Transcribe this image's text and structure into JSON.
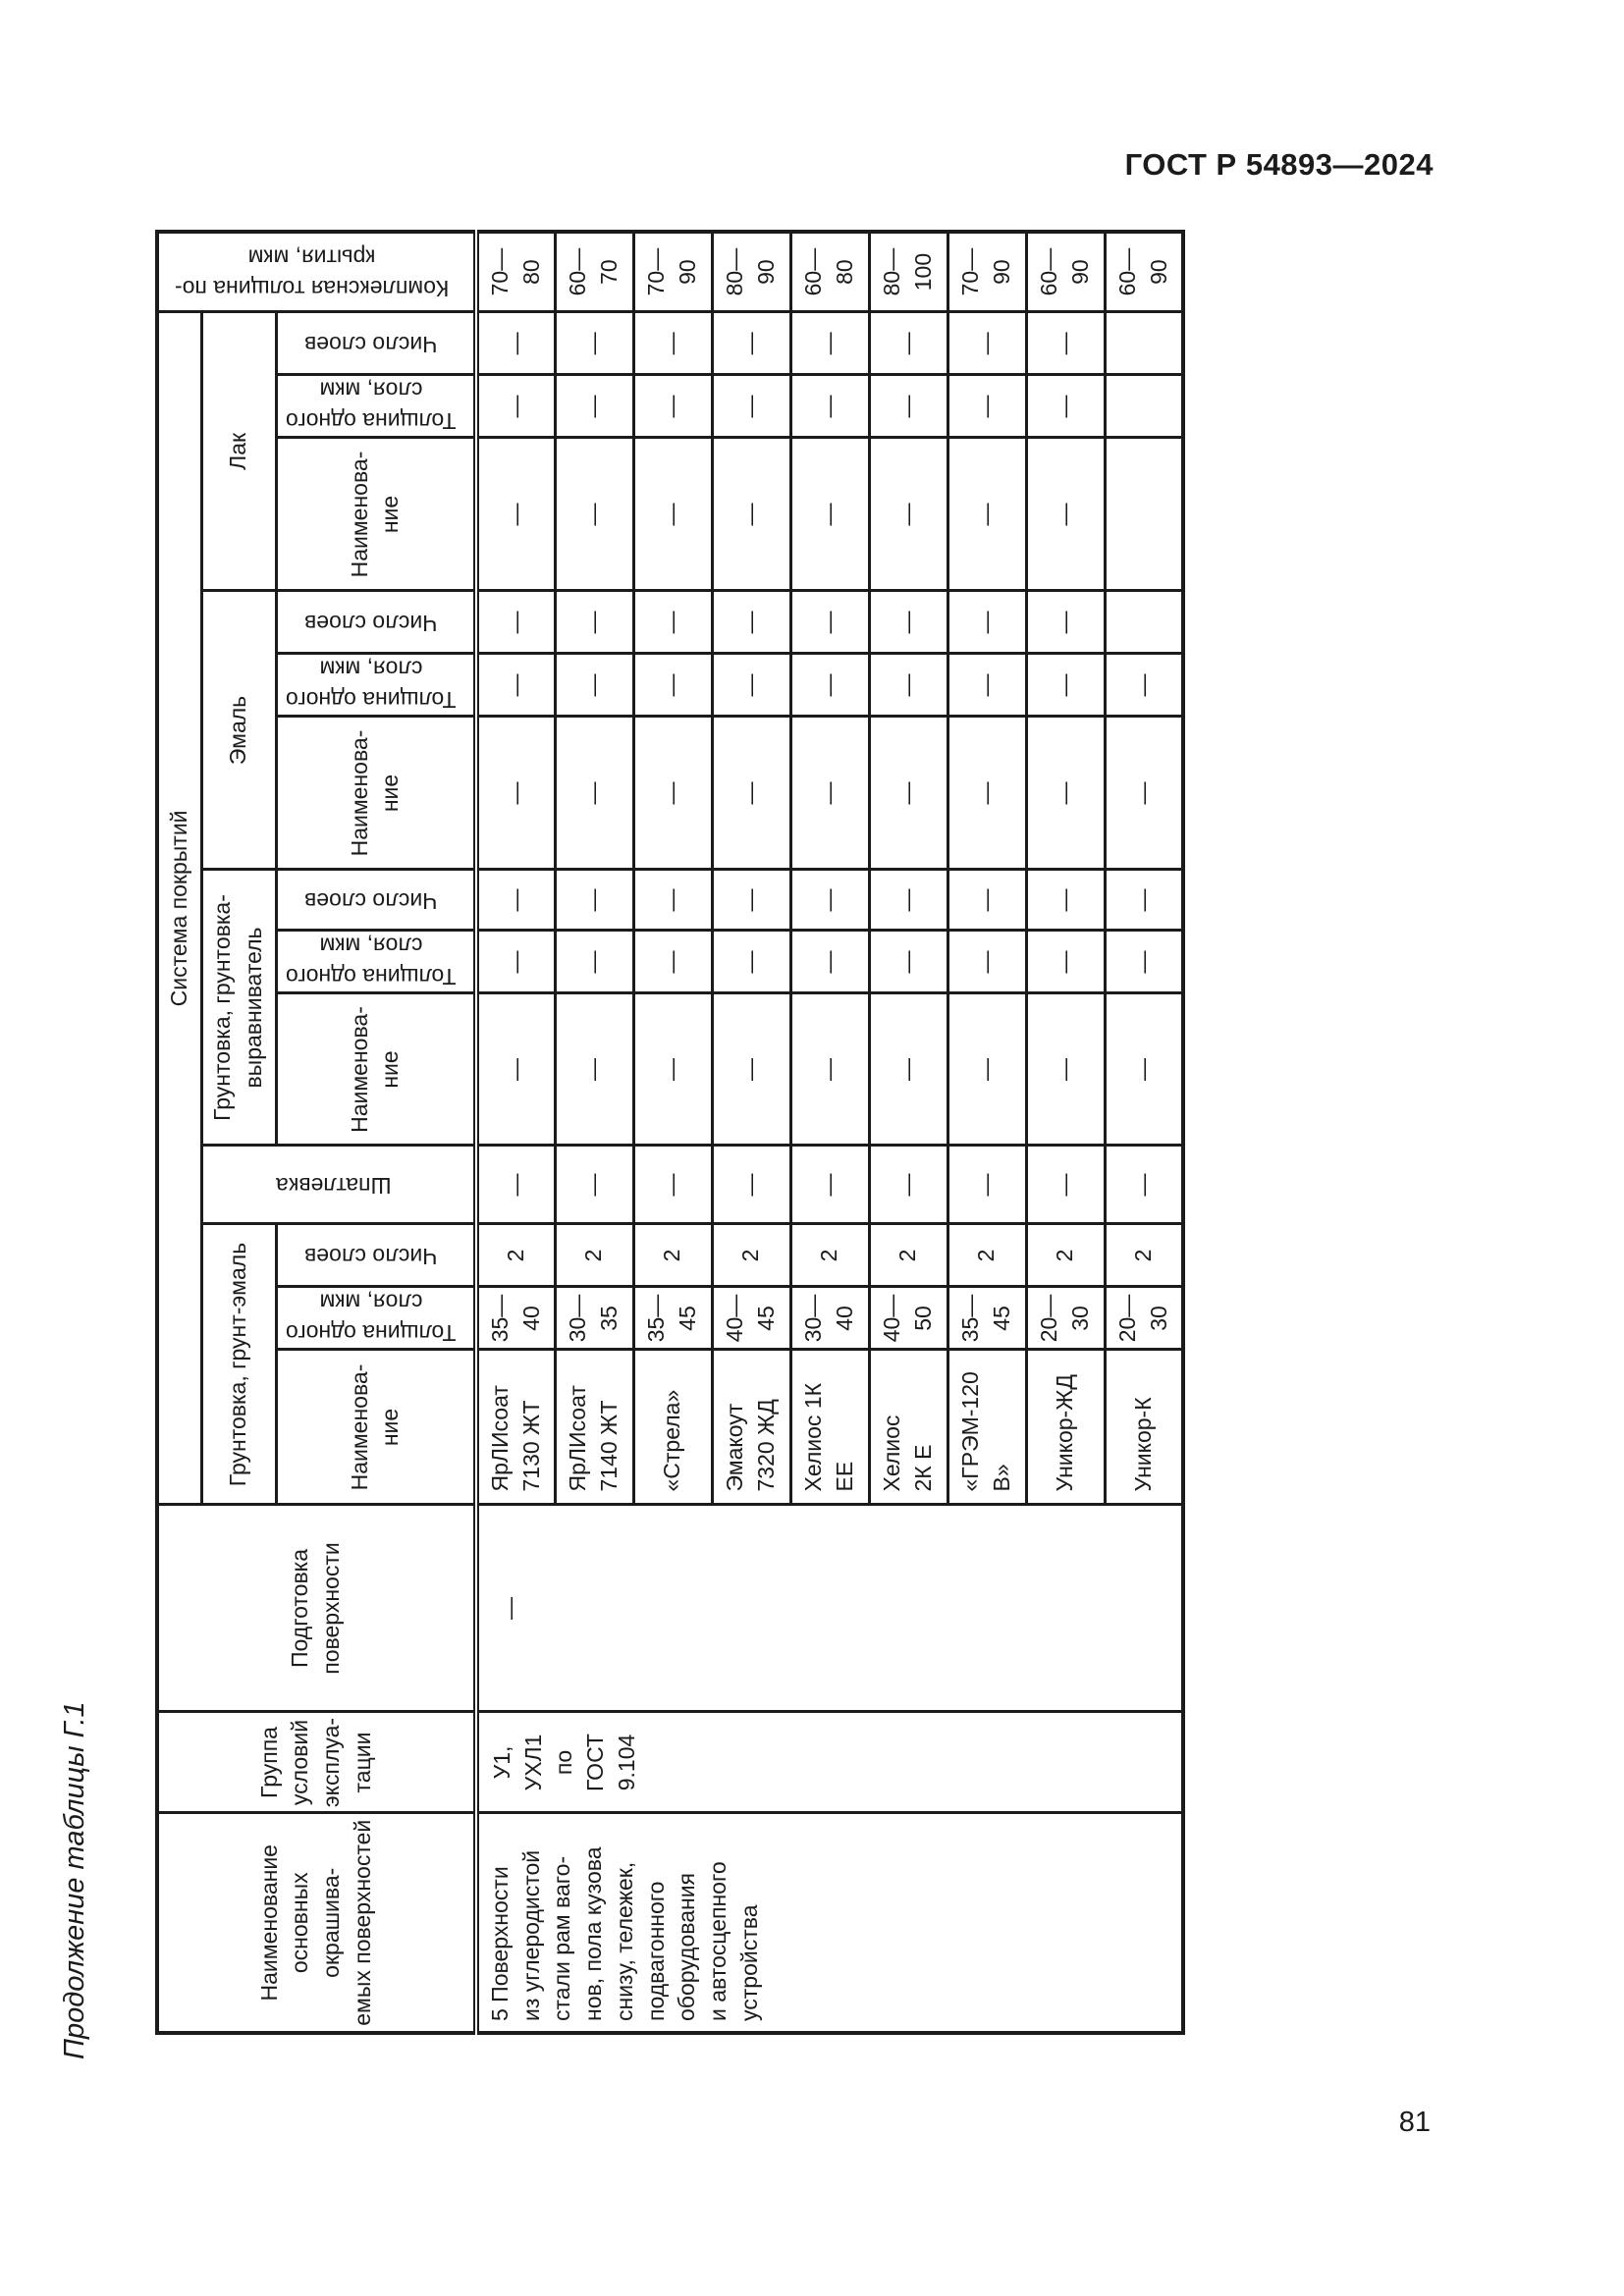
{
  "page": {
    "doc_header": "ГОСТ Р 54893—2024",
    "table_caption": "Продолжение таблицы Г.1",
    "page_number": "81"
  },
  "table": {
    "headers": {
      "surface": "Наименование\nосновных окрашива-\nемых поверхностей",
      "service_group": "Группа\nусловий\nэксплуа-\nтации",
      "prep": "Подготовка\nповерхности",
      "system": "Система покрытий",
      "primer_enamel": "Грунтовка, грунт-эмаль",
      "putty": "Шпатлевка",
      "primer_leveler": "Грунтовка, грунтовка-\nвыравниватель",
      "enamel": "Эмаль",
      "lacquer": "Лак",
      "name": "Наименова-\nние",
      "thickness": "Толщина одного\nслоя, мкм",
      "layers": "Число слоев",
      "total": "Комплексная толщина по-\nкрытия, мкм"
    },
    "merged": {
      "surface": "5 Поверхности\nиз углеродистой\nстали рам ваго-\nнов, пола кузова\nснизу, тележек,\nподвагонного\nоборудования\nи автосцепного\nустройства",
      "service_group": "У1,\nУХЛ1\nпо\nГОСТ\n9.104",
      "prep": "—"
    },
    "rows": [
      {
        "pe_name": "ЯрЛИсоат\n7130 ЖТ",
        "pe_thk": "35—\n40",
        "pe_n": "2",
        "putty": "—",
        "pl_name": "—",
        "pl_thk": "—",
        "pl_n": "—",
        "en_name": "—",
        "en_thk": "—",
        "en_n": "—",
        "lq_name": "—",
        "lq_thk": "—",
        "lq_n": "—",
        "total": "70—\n80"
      },
      {
        "pe_name": "ЯрЛИсоат\n7140 ЖТ",
        "pe_thk": "30—\n35",
        "pe_n": "2",
        "putty": "—",
        "pl_name": "—",
        "pl_thk": "—",
        "pl_n": "—",
        "en_name": "—",
        "en_thk": "—",
        "en_n": "—",
        "lq_name": "—",
        "lq_thk": "—",
        "lq_n": "—",
        "total": "60—\n70"
      },
      {
        "pe_name": "«Стрела»",
        "pe_thk": "35—\n45",
        "pe_n": "2",
        "putty": "—",
        "pl_name": "—",
        "pl_thk": "—",
        "pl_n": "—",
        "en_name": "—",
        "en_thk": "—",
        "en_n": "—",
        "lq_name": "—",
        "lq_thk": "—",
        "lq_n": "—",
        "total": "70—\n90"
      },
      {
        "pe_name": "Эмакоут\n7320 ЖД",
        "pe_thk": "40—\n45",
        "pe_n": "2",
        "putty": "—",
        "pl_name": "—",
        "pl_thk": "—",
        "pl_n": "—",
        "en_name": "—",
        "en_thk": "—",
        "en_n": "—",
        "lq_name": "—",
        "lq_thk": "—",
        "lq_n": "—",
        "total": "80—\n90"
      },
      {
        "pe_name": "Хелиос 1К\nЕЕ",
        "pe_thk": "30—\n40",
        "pe_n": "2",
        "putty": "—",
        "pl_name": "—",
        "pl_thk": "—",
        "pl_n": "—",
        "en_name": "—",
        "en_thk": "—",
        "en_n": "—",
        "lq_name": "—",
        "lq_thk": "—",
        "lq_n": "—",
        "total": "60—\n80"
      },
      {
        "pe_name": "Хелиос\n2К Е",
        "pe_thk": "40—\n50",
        "pe_n": "2",
        "putty": "—",
        "pl_name": "—",
        "pl_thk": "—",
        "pl_n": "—",
        "en_name": "—",
        "en_thk": "—",
        "en_n": "—",
        "lq_name": "—",
        "lq_thk": "—",
        "lq_n": "—",
        "total": "80—\n100"
      },
      {
        "pe_name": "«ГРЭМ-120\nВ»",
        "pe_thk": "35—\n45",
        "pe_n": "2",
        "putty": "—",
        "pl_name": "—",
        "pl_thk": "—",
        "pl_n": "—",
        "en_name": "—",
        "en_thk": "—",
        "en_n": "—",
        "lq_name": "—",
        "lq_thk": "—",
        "lq_n": "—",
        "total": "70—\n90"
      },
      {
        "pe_name": "Уникор-ЖД",
        "pe_thk": "20—\n30",
        "pe_n": "2",
        "putty": "—",
        "pl_name": "—",
        "pl_thk": "—",
        "pl_n": "—",
        "en_name": "—",
        "en_thk": "—",
        "en_n": "—",
        "lq_name": "—",
        "lq_thk": "—",
        "lq_n": "—",
        "total": "60—\n90"
      },
      {
        "pe_name": "Уникор-К",
        "pe_thk": "20—\n30",
        "pe_n": "2",
        "putty": "—",
        "pl_name": "—",
        "pl_thk": "—",
        "pl_n": "—",
        "en_name": "—",
        "en_thk": "—",
        "en_n": "",
        "lq_name": "",
        "lq_thk": "",
        "lq_n": "",
        "total": "60—\n90"
      }
    ]
  }
}
